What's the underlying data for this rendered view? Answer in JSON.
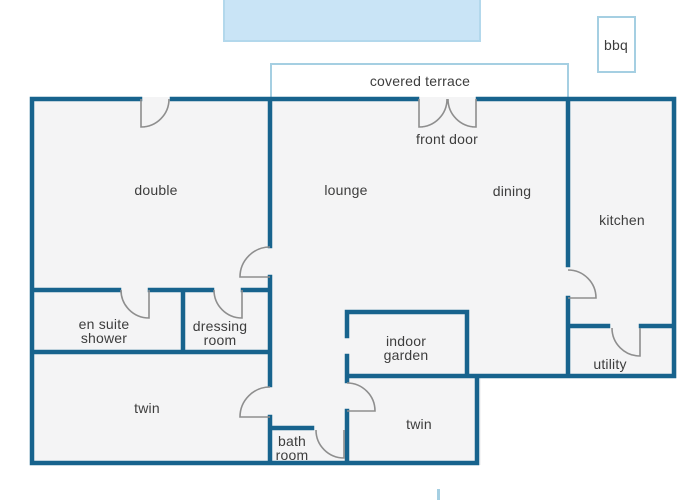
{
  "floorplan": {
    "outdoor": {
      "covered_terrace": "covered terrace",
      "front_door": "front door",
      "bbq": "bbq"
    },
    "rooms": {
      "double": "double",
      "lounge": "lounge",
      "dining": "dining",
      "kitchen": "kitchen",
      "en_suite_shower": "en suite shower",
      "dressing_room": "dressing room",
      "twin_left": "twin",
      "indoor_garden": "indoor garden",
      "twin_right": "twin",
      "bath_room": "bath room",
      "utility": "utility"
    }
  },
  "colors": {
    "wall": "#17638d",
    "room_fill": "#f4f4f5",
    "door_arc": "#8e8e8e",
    "label_text": "#3d3d3d",
    "terrace_border": "#a5cfe2",
    "pool_fill": "#c9e4f6",
    "pool_border": "#b3d8ec",
    "background": "#ffffff"
  }
}
